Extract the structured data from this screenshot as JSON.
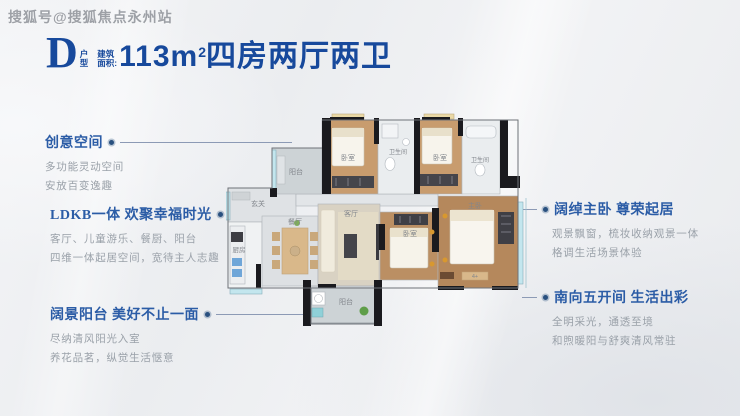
{
  "watermark": "搜狐号@搜狐焦点永州站",
  "title": {
    "letter": "D",
    "letter_sub_top": "户",
    "letter_sub_bottom": "型",
    "area_label_top": "建筑",
    "area_label_bottom": "面积:",
    "area_value": "113m",
    "area_sup": "2",
    "rooms_text": "四房两厅两卫"
  },
  "annotations": {
    "left": [
      {
        "title": "创意空间",
        "lines": [
          "多功能灵动空间",
          "安放百变逸趣"
        ]
      },
      {
        "title": "LDKB一体 欢聚幸福时光",
        "lines": [
          "客厅、儿童游乐、餐厨、阳台",
          "四维一体起居空间，宽待主人志趣"
        ]
      },
      {
        "title": "阔景阳台 美好不止一面",
        "lines": [
          "尽纳清风阳光入室",
          "养花品茗，纵觉生活惬意"
        ]
      }
    ],
    "right": [
      {
        "title": "阔绰主卧 尊荣起居",
        "lines": [
          "观景飘窗，梳妆收纳观景一体",
          "格调生活场景体验"
        ]
      },
      {
        "title": "南向五开间 生活出彩",
        "lines": [
          "全明采光，通透至境",
          "和煦暖阳与舒爽清风常驻"
        ]
      }
    ]
  },
  "floorplan": {
    "rooms": {
      "balcony_top": "阳台",
      "bedroom_top1": "卧室",
      "bath1": "卫生间",
      "bedroom_top2": "卧室",
      "bath2": "卫生间",
      "entry": "玄关",
      "kitchen": "厨房",
      "dining": "餐厅",
      "living": "客厅",
      "bedroom_south": "卧室",
      "master": "主卧",
      "balcony_bottom": "阳台"
    },
    "master_tag": "4+"
  },
  "colors": {
    "title_blue": "#17499c",
    "annotation_blue": "#2b5ca6",
    "body_gray": "#9aa1a9",
    "wall_black": "#1a1a1e",
    "window_cyan": "#c3e6ee",
    "wood_floor": "#c0935f",
    "balcony_gray": "#cdd3d6"
  }
}
